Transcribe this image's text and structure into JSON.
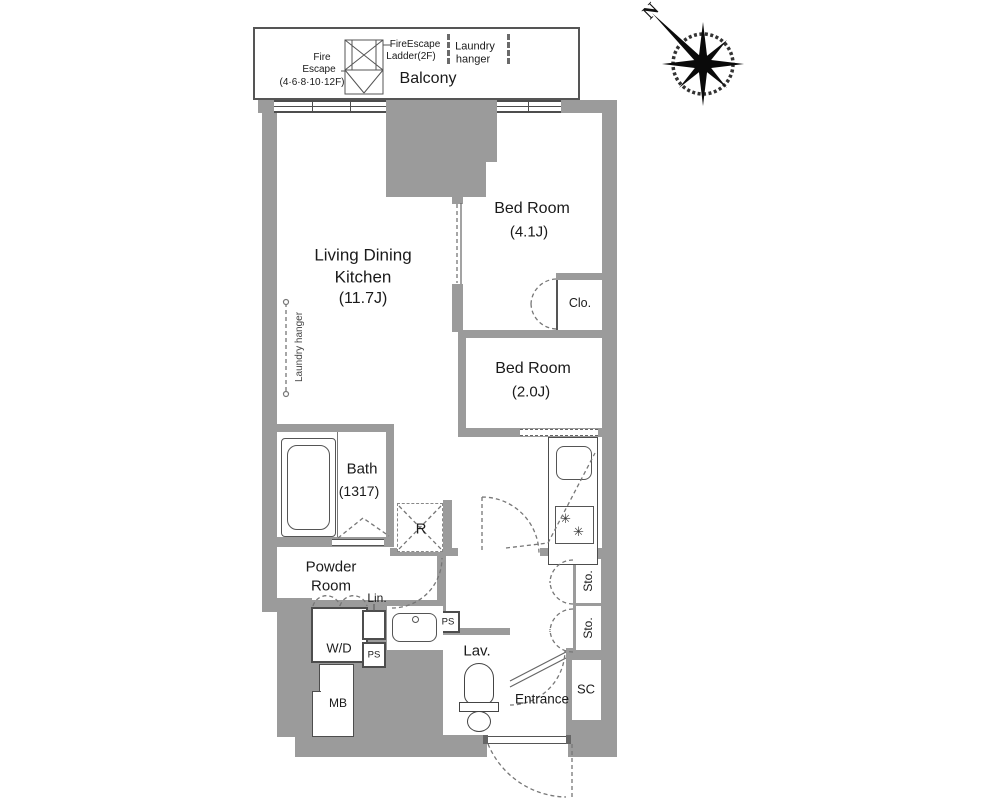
{
  "colors": {
    "wall": "#9b9b9b",
    "line": "#4a4a4a",
    "dash": "#777777",
    "text": "#1a1a1a"
  },
  "compass": {
    "north": "N"
  },
  "balcony": {
    "label": "Balcony",
    "fire_escape1": "Fire",
    "fire_escape2": "Escape",
    "fire_escape3": "(4·6·8·10·12F)",
    "ladder1": "FireEscape",
    "ladder2": "Ladder(2F)",
    "laundry1": "Laundry",
    "laundry2": "hanger"
  },
  "rooms": {
    "ldk1": "Living Dining",
    "ldk2": "Kitchen",
    "ldk_size": "(11.7J)",
    "ldk_laundry": "Laundry hanger",
    "bed1_name": "Bed Room",
    "bed1_size": "(4.1J)",
    "bed2_name": "Bed Room",
    "bed2_size": "(2.0J)",
    "bath_name": "Bath",
    "bath_size": "(1317)",
    "powder1": "Powder",
    "powder2": "Room",
    "lav": "Lav.",
    "entrance": "Entrance"
  },
  "fixtures": {
    "closet": "Clo.",
    "fridge": "R",
    "linen": "Lin.",
    "ps1": "PS",
    "ps2": "PS",
    "wd": "W/D",
    "mb": "MB",
    "sc": "SC",
    "sto1": "Sto.",
    "sto2": "Sto.",
    "burner": "✳"
  }
}
